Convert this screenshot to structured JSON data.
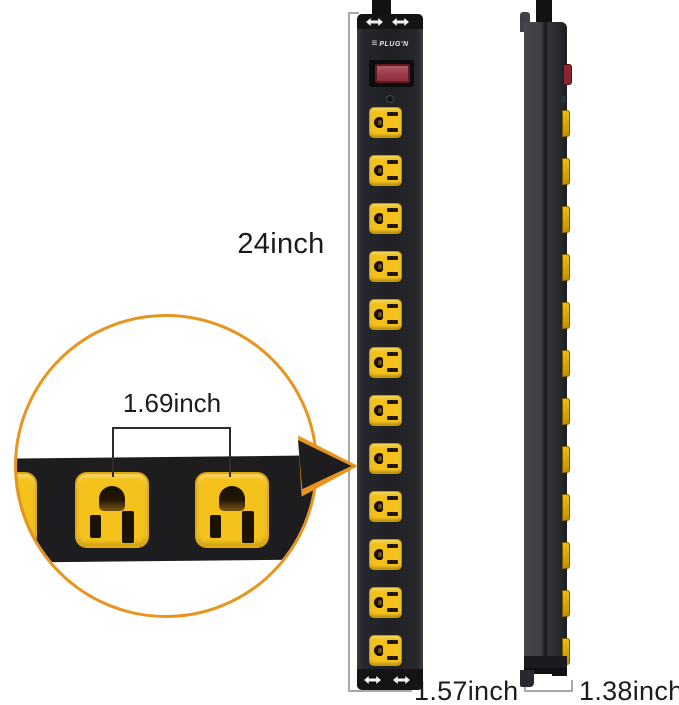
{
  "labels": {
    "height": "24inch",
    "outlet_spacing": "1.69inch",
    "front_width": "1.57inch",
    "side_depth": "1.38inch"
  },
  "front_view": {
    "brand": "PLUG'N",
    "outlet_count": 12
  },
  "side_view": {
    "outlet_count": 12
  },
  "callout": {
    "outlet_count": 2
  },
  "colors": {
    "accent_orange": "#E8951F",
    "outlet_yellow": "#F5C21C",
    "body_black": "#232326",
    "side_gray": "#3C3E44",
    "switch_red": "#9C3A48",
    "label_text": "#1C1C1C"
  }
}
